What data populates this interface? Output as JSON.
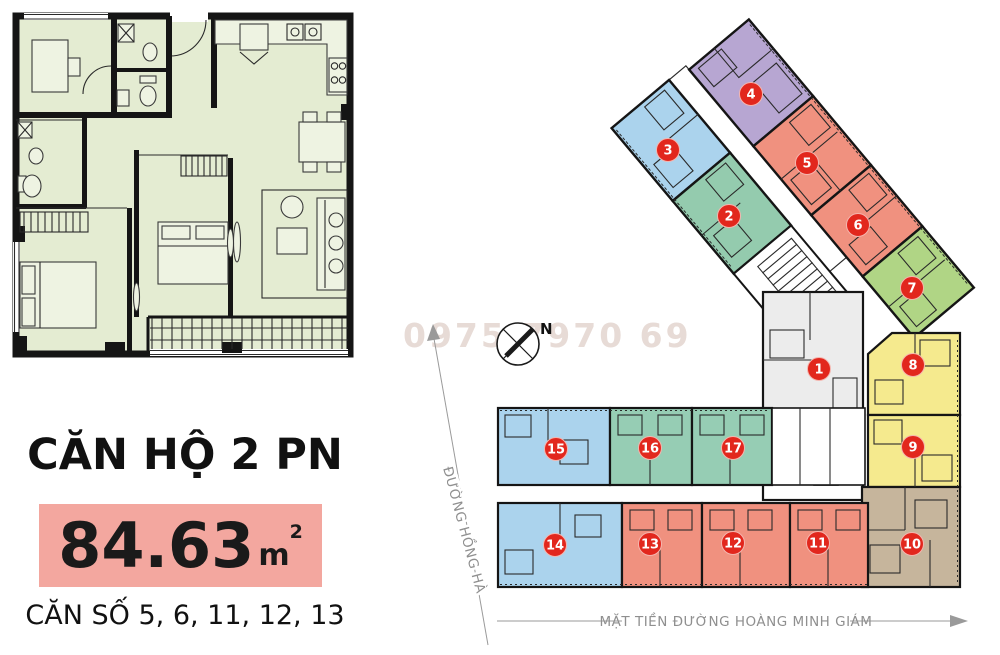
{
  "left_panel": {
    "title": "CĂN HỘ 2 PN",
    "area_value": "84.63",
    "area_unit": "m",
    "area_sup": "2",
    "units_line": "CĂN SỐ 5, 6, 11, 12, 13",
    "highlight_color": "#f3a79f"
  },
  "site_plan": {
    "watermark": "0975 7970 69",
    "compass_label": "N",
    "street_left_label": "ĐƯỜNG HỒNG HÀ",
    "street_bottom_label": "MẶT TIỀN ĐƯỜNG HOÀNG MINH GIÁM",
    "marker_color": "#e2271d",
    "units": [
      {
        "number": "1",
        "color": "#ececec",
        "x": 819,
        "y": 369
      },
      {
        "number": "2",
        "color": "#94cbae",
        "x": 729,
        "y": 216
      },
      {
        "number": "3",
        "color": "#abd3ed",
        "x": 668,
        "y": 150
      },
      {
        "number": "4",
        "color": "#b7a6d2",
        "x": 751,
        "y": 94
      },
      {
        "number": "5",
        "color": "#f0917f",
        "x": 807,
        "y": 163
      },
      {
        "number": "6",
        "color": "#f0917f",
        "x": 858,
        "y": 225
      },
      {
        "number": "7",
        "color": "#b0d585",
        "x": 912,
        "y": 288
      },
      {
        "number": "8",
        "color": "#f5ea8e",
        "x": 913,
        "y": 365
      },
      {
        "number": "9",
        "color": "#f5ea8e",
        "x": 913,
        "y": 447
      },
      {
        "number": "10",
        "color": "#c6b59c",
        "x": 912,
        "y": 544
      },
      {
        "number": "11",
        "color": "#f0917f",
        "x": 818,
        "y": 543
      },
      {
        "number": "12",
        "color": "#f0917f",
        "x": 733,
        "y": 543
      },
      {
        "number": "13",
        "color": "#f0917f",
        "x": 650,
        "y": 544
      },
      {
        "number": "14",
        "color": "#abd3ed",
        "x": 555,
        "y": 545
      },
      {
        "number": "15",
        "color": "#abd3ed",
        "x": 556,
        "y": 449
      },
      {
        "number": "16",
        "color": "#96cdb4",
        "x": 650,
        "y": 448
      },
      {
        "number": "17",
        "color": "#96cdb4",
        "x": 733,
        "y": 448
      }
    ]
  }
}
